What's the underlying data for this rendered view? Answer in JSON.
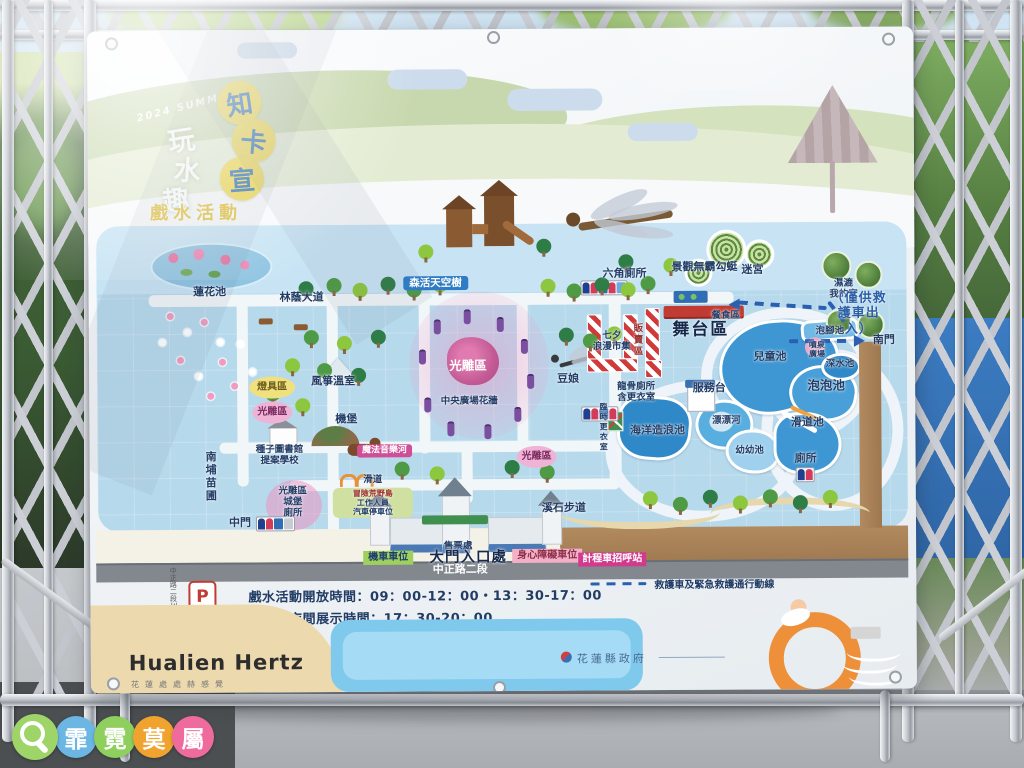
{
  "banner": {
    "title": {
      "year_tag": "2024 SUMMER",
      "brand_chars": [
        "玩",
        "水",
        "趣"
      ],
      "park_chars": [
        "知",
        "卡",
        "宣"
      ],
      "subtitle": "戲水活動"
    },
    "info": {
      "parking_letter": "P",
      "parking_name": "南埔營區",
      "street_side": "中正路二段304巷",
      "hours_line1": "戲水活動開放時間：09：00-12：00・13：30-17：00",
      "hours_line2": "光雕區夜間展示時間：17：30-20：00",
      "legend_emergency": "救護車及緊急救護通行動線"
    },
    "footer": {
      "logo": "Hualien Hertz",
      "logo_sub": "花蓮處處赫感覺",
      "gov": "花蓮縣政府"
    }
  },
  "map": {
    "labels": [
      {
        "t": "蓮花池",
        "x": 121,
        "y": 262,
        "c": "sm",
        "n": "label-lotus-pond"
      },
      {
        "t": "林蔭大道",
        "x": 213,
        "y": 268,
        "c": "sm",
        "n": "label-tree-avenue"
      },
      {
        "t": "森活天空樹",
        "x": 347,
        "y": 254,
        "c": "bluebadge",
        "n": "label-sky-tree"
      },
      {
        "t": "景觀無霸勾蜓",
        "x": 616,
        "y": 240,
        "c": "sm",
        "n": "label-dragonfly"
      },
      {
        "t": "六角廁所",
        "x": 536,
        "y": 246,
        "c": "sm",
        "n": "label-hex-toilet"
      },
      {
        "t": "迷宮",
        "x": 664,
        "y": 243,
        "c": "sm",
        "n": "label-maze"
      },
      {
        "t": "濕漉\n我的家",
        "x": 755,
        "y": 262,
        "c": "xs",
        "n": "label-wetland-home"
      },
      {
        "t": "（僅供救護車出入）",
        "x": 770,
        "y": 287,
        "c": "blue",
        "n": "label-ambulance-only"
      },
      {
        "t": "南門",
        "x": 795,
        "y": 314,
        "c": "sm",
        "n": "label-south-gate"
      },
      {
        "t": "餐食區",
        "x": 637,
        "y": 288,
        "c": "xs",
        "n": "label-food-area"
      },
      {
        "t": "舞台區",
        "x": 612,
        "y": 302,
        "c": "big",
        "n": "label-stage-area"
      },
      {
        "t": "販賣區",
        "x": 548,
        "y": 312,
        "c": "red vert xs",
        "n": "label-vendor-area"
      },
      {
        "t": "七夕\n浪漫市集",
        "x": 523,
        "y": 313,
        "c": "xs",
        "n": "label-qixi-market"
      },
      {
        "t": "豆娘",
        "x": 479,
        "y": 351,
        "c": "sm",
        "n": "label-damselfly"
      },
      {
        "t": "光雕區",
        "x": 379,
        "y": 337,
        "c": "white md",
        "n": "label-light-area-center"
      },
      {
        "t": "中央廣場花牆",
        "x": 380,
        "y": 372,
        "c": "xs",
        "n": "label-flower-wall"
      },
      {
        "t": "燈具區",
        "x": 183,
        "y": 357,
        "c": "yoval",
        "n": "label-lamp-area"
      },
      {
        "t": "光雕區",
        "x": 183,
        "y": 382,
        "c": "poval",
        "n": "label-light-area-west"
      },
      {
        "t": "風箏溫室",
        "x": 244,
        "y": 352,
        "c": "sm",
        "n": "label-kite-greenhouse"
      },
      {
        "t": "機堡",
        "x": 257,
        "y": 390,
        "c": "sm",
        "n": "label-bunker"
      },
      {
        "t": "種子圖書館\n提案學校",
        "x": 190,
        "y": 425,
        "c": "xs",
        "n": "label-seed-library"
      },
      {
        "t": "魔法音樂河",
        "x": 295,
        "y": 421,
        "c": "pinkbadge",
        "n": "label-magic-music-river"
      },
      {
        "t": "光雕區",
        "x": 447,
        "y": 428,
        "c": "poval",
        "n": "label-light-area-mid"
      },
      {
        "t": "南埔苗圃",
        "x": 120,
        "y": 446,
        "c": "sm vert",
        "n": "label-nanpu-nursery"
      },
      {
        "t": "光雕區\n城堡\n廁所",
        "x": 203,
        "y": 472,
        "c": "xs",
        "n": "label-castle-toilet"
      },
      {
        "t": "中門",
        "x": 150,
        "y": 493,
        "c": "sm",
        "n": "label-middle-gate"
      },
      {
        "t": "滑道",
        "x": 283,
        "y": 450,
        "c": "xs",
        "n": "label-slide"
      },
      {
        "t": "冒險荒野島",
        "x": 283,
        "y": 464,
        "c": "red tiny",
        "n": "label-adventure-island"
      },
      {
        "t": "工作人員\n汽車停車位",
        "x": 283,
        "y": 478,
        "c": "tiny",
        "n": "label-staff-parking"
      },
      {
        "t": "售票處",
        "x": 368,
        "y": 517,
        "c": "xs",
        "n": "label-ticket-office"
      },
      {
        "t": "大門入口處",
        "x": 378,
        "y": 529,
        "c": "big2",
        "n": "label-main-entrance"
      },
      {
        "t": "機車車位",
        "x": 298,
        "y": 528,
        "c": "greenbadge",
        "n": "label-scooter-parking"
      },
      {
        "t": "身心障礙車位",
        "x": 457,
        "y": 527,
        "c": "rosebadge",
        "n": "label-accessible-parking"
      },
      {
        "t": "計程車招呼站",
        "x": 522,
        "y": 531,
        "c": "magbadge",
        "n": "label-taxi-stand"
      },
      {
        "t": "中正路二段",
        "x": 370,
        "y": 541,
        "c": "white sm",
        "n": "label-zhongzheng-road"
      },
      {
        "t": "溪石步道",
        "x": 474,
        "y": 480,
        "c": "sm",
        "n": "label-stone-trail"
      },
      {
        "t": "兒童池",
        "x": 681,
        "y": 330,
        "c": "sm",
        "n": "label-children-pool"
      },
      {
        "t": "泡腳池",
        "x": 741,
        "y": 304,
        "c": "xs",
        "n": "label-foot-bath-pool"
      },
      {
        "t": "噴泉\n廣場",
        "x": 728,
        "y": 323,
        "c": "tiny",
        "n": "label-fountain-plaza"
      },
      {
        "t": "深水池",
        "x": 751,
        "y": 337,
        "c": "xs",
        "n": "label-deep-pool"
      },
      {
        "t": "泡泡池",
        "x": 737,
        "y": 359,
        "c": "md",
        "n": "label-bubble-pool"
      },
      {
        "t": "滑道池",
        "x": 718,
        "y": 396,
        "c": "sm",
        "n": "label-slide-pool"
      },
      {
        "t": "服務台",
        "x": 620,
        "y": 361,
        "c": "sm",
        "n": "label-service-desk"
      },
      {
        "t": "漂漂河",
        "x": 637,
        "y": 393,
        "c": "xs",
        "n": "label-lazy-river"
      },
      {
        "t": "幼幼池",
        "x": 660,
        "y": 423,
        "c": "xs",
        "n": "label-toddler-pool"
      },
      {
        "t": "海洋造浪池",
        "x": 568,
        "y": 403,
        "c": "sm",
        "n": "label-wave-pool"
      },
      {
        "t": "龍骨廁所\n含更衣室",
        "x": 547,
        "y": 364,
        "c": "xs",
        "n": "label-dragonbone-toilet"
      },
      {
        "t": "臨時更衣室",
        "x": 514,
        "y": 399,
        "c": "tiny vert",
        "n": "label-temp-changing-room"
      },
      {
        "t": "廁所",
        "x": 716,
        "y": 432,
        "c": "sm",
        "n": "label-toilet-se"
      }
    ],
    "tree_colors": [
      "#4f9a44",
      "#8dc63f",
      "#2f7d46"
    ],
    "trees": [
      [
        238,
        248,
        0
      ],
      [
        264,
        253,
        1
      ],
      [
        292,
        247,
        2
      ],
      [
        318,
        253,
        0
      ],
      [
        344,
        248,
        1
      ],
      [
        210,
        251,
        2
      ],
      [
        452,
        250,
        1
      ],
      [
        478,
        255,
        0
      ],
      [
        506,
        249,
        2
      ],
      [
        532,
        254,
        1
      ],
      [
        330,
        215,
        1
      ],
      [
        448,
        210,
        2
      ],
      [
        215,
        300,
        0
      ],
      [
        248,
        306,
        1
      ],
      [
        282,
        300,
        2
      ],
      [
        196,
        328,
        1
      ],
      [
        228,
        333,
        0
      ],
      [
        262,
        338,
        2
      ],
      [
        176,
        356,
        0
      ],
      [
        206,
        368,
        1
      ],
      [
        470,
        299,
        2
      ],
      [
        494,
        305,
        0
      ],
      [
        518,
        298,
        1
      ],
      [
        305,
        432,
        0
      ],
      [
        340,
        437,
        1
      ],
      [
        415,
        431,
        2
      ],
      [
        450,
        436,
        0
      ],
      [
        553,
        463,
        1
      ],
      [
        583,
        469,
        0
      ],
      [
        613,
        462,
        2
      ],
      [
        643,
        468,
        1
      ],
      [
        673,
        462,
        0
      ],
      [
        703,
        468,
        2
      ],
      [
        733,
        463,
        1
      ],
      [
        530,
        226,
        2
      ],
      [
        552,
        248,
        0
      ],
      [
        575,
        230,
        1
      ]
    ],
    "flower_colors": [
      "#f29bc0",
      "#ffffff"
    ],
    "flowers": [
      [
        78,
        282,
        0
      ],
      [
        95,
        298,
        1
      ],
      [
        112,
        288,
        0
      ],
      [
        128,
        308,
        1
      ],
      [
        88,
        326,
        0
      ],
      [
        106,
        342,
        1
      ],
      [
        130,
        328,
        0
      ],
      [
        148,
        310,
        1
      ],
      [
        70,
        308,
        1
      ],
      [
        142,
        352,
        0
      ],
      [
        160,
        338,
        1
      ],
      [
        118,
        362,
        0
      ]
    ],
    "lanterns": [
      [
        345,
        290
      ],
      [
        375,
        280
      ],
      [
        408,
        288
      ],
      [
        432,
        310
      ],
      [
        438,
        345
      ],
      [
        425,
        378
      ],
      [
        395,
        395
      ],
      [
        358,
        392
      ],
      [
        335,
        368
      ],
      [
        330,
        320
      ]
    ]
  },
  "watermark": {
    "chars": [
      "霏",
      "霓",
      "莫",
      "屬"
    ],
    "colors": [
      "#6cb6e4",
      "#8fcf5e",
      "#f0a32f",
      "#ef6b9d"
    ],
    "magnifier_color": "#9fd468"
  },
  "colors": {
    "map_water": "#b7d9ec",
    "pool_blue": "#3e97d3",
    "road_brown": "#a9835c",
    "badge_pink": "#cf4f96",
    "title_yellow": "#f0d94e",
    "title_blue": "#2c6fb5"
  }
}
